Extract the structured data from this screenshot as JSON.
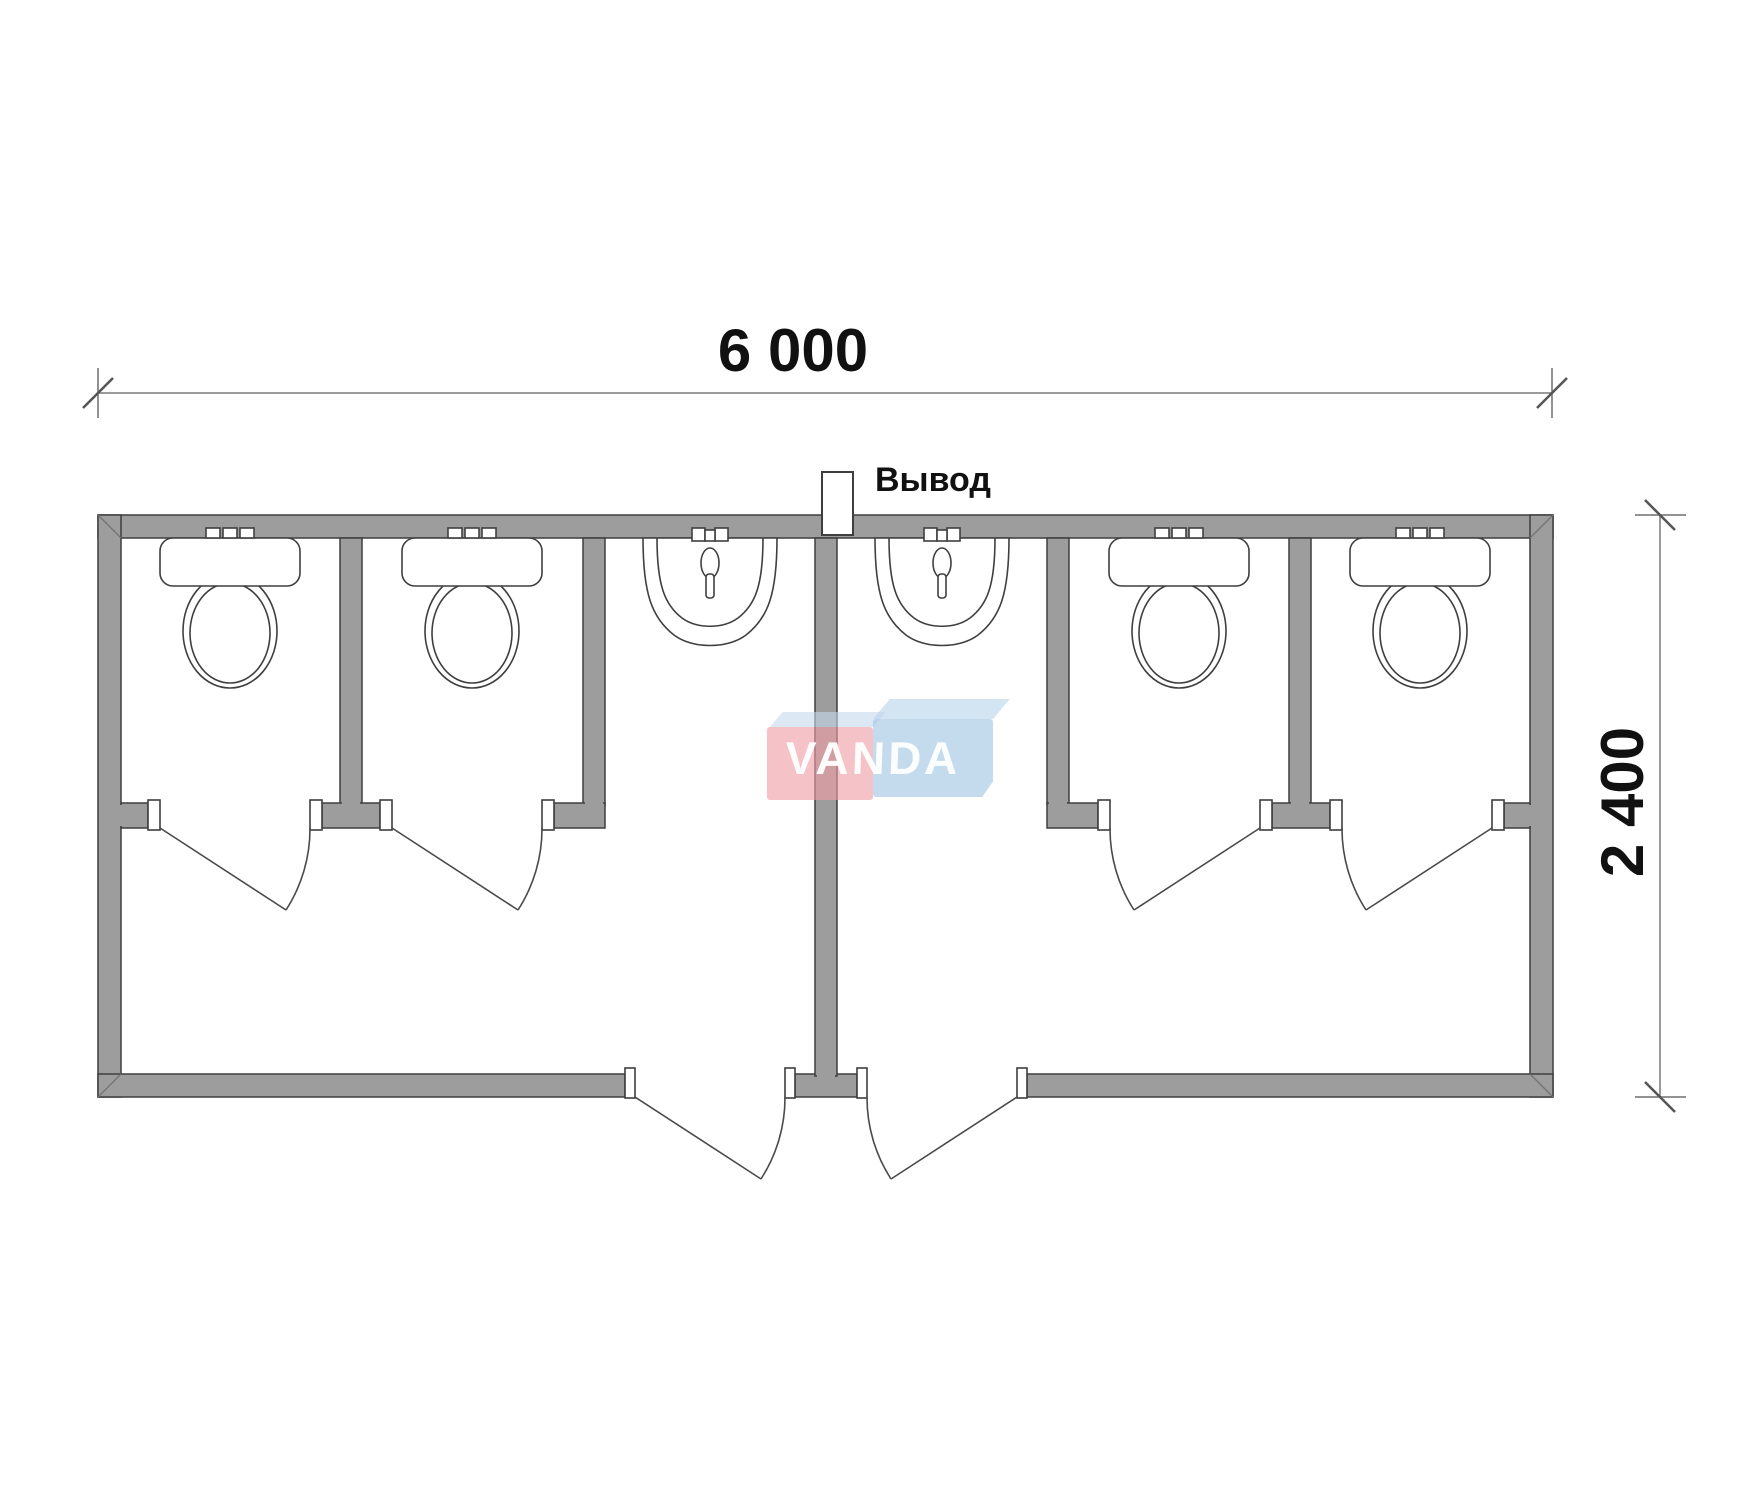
{
  "drawing": {
    "dimensions": {
      "width_label": "6 000",
      "height_label": "2 400"
    },
    "outlet_label": "Вывод",
    "watermark": {
      "text": "VANDA"
    },
    "colors": {
      "wall_fill": "#9d9d9d",
      "wall_stroke": "#3e3e3e",
      "line": "#4a4a4a",
      "dimension_line": "#7a7a7a",
      "text": "#111111",
      "watermark_red": "#ee9da4",
      "watermark_blue": "#a0c4e2",
      "watermark_top": "#c4dbee"
    },
    "fixtures": {
      "toilets": 4,
      "sinks": 2,
      "stall_doors": 4,
      "entrance_doors": 2
    }
  }
}
